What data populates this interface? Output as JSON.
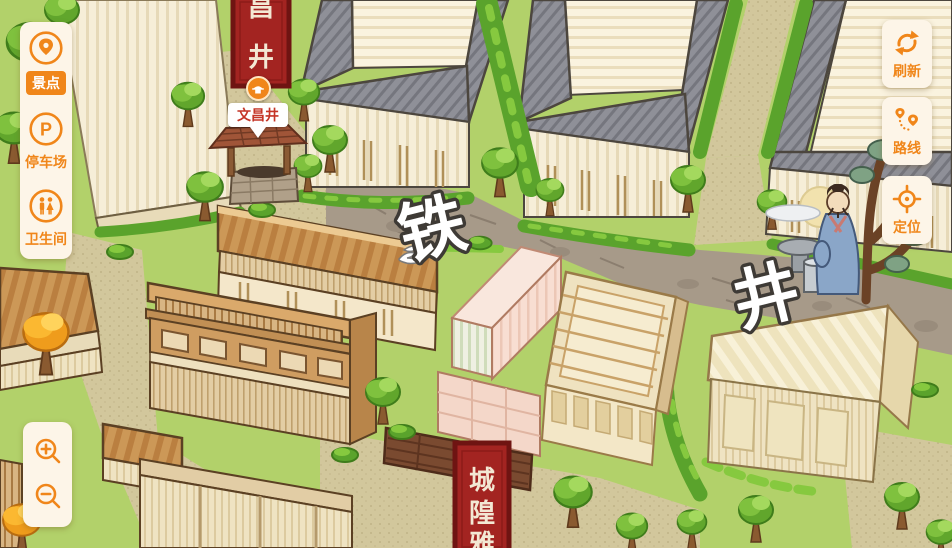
{
  "colors": {
    "accent_orange": "#f0861a",
    "panel_bg": "#fdf5e8",
    "banner_red": "#a32421",
    "banner_border": "#6f1412",
    "poi_label_red": "#c53527",
    "grass": "#b2d16a",
    "path_khaki": "#d2c79c",
    "road_gray": "#a79a89"
  },
  "sidebar": {
    "items": [
      {
        "label": "景点",
        "icon": "scenic-spots-icon",
        "active": true
      },
      {
        "label": "停车场",
        "icon": "parking-icon",
        "active": false
      },
      {
        "label": "卫生间",
        "icon": "restroom-icon",
        "active": false
      }
    ]
  },
  "map_controls": {
    "buttons": [
      {
        "label": "刷新",
        "icon": "refresh-icon"
      },
      {
        "label": "路线",
        "icon": "route-icon"
      },
      {
        "label": "定位",
        "icon": "locate-icon"
      }
    ]
  },
  "map": {
    "street_labels": [
      {
        "text": "铁"
      },
      {
        "text": "井"
      }
    ],
    "banners": {
      "top": {
        "chars": [
          "昌",
          "井"
        ]
      },
      "bottom": {
        "chars": [
          "城",
          "隍",
          "雅"
        ]
      }
    },
    "marker": {
      "label": "文昌井"
    }
  }
}
